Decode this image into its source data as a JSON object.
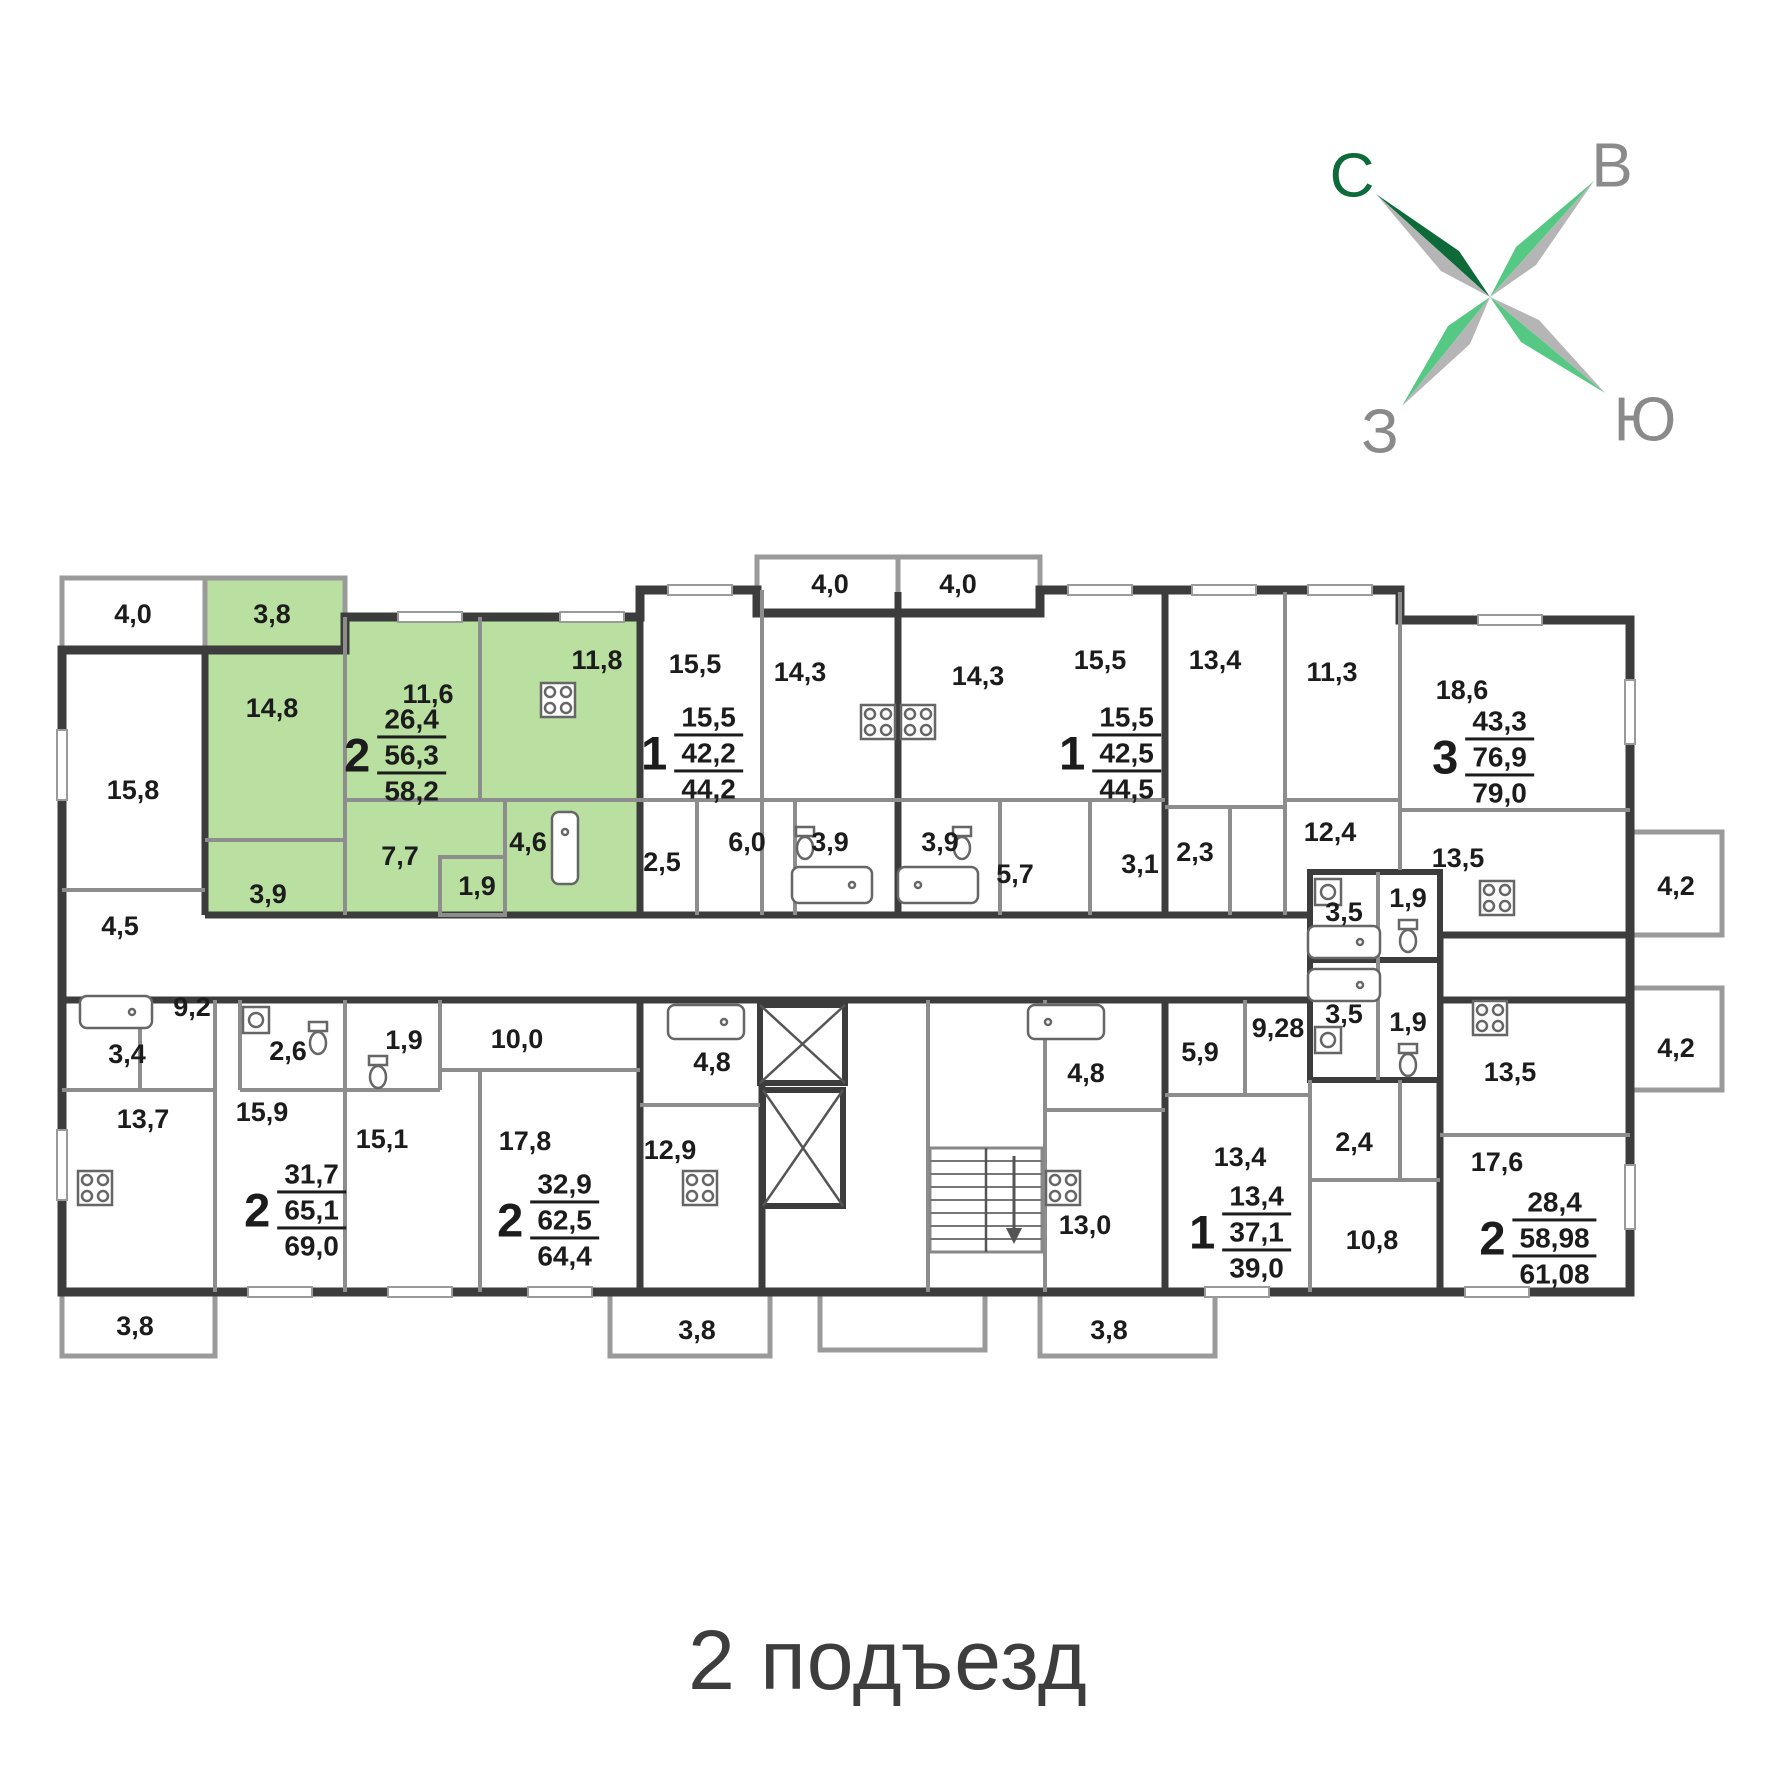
{
  "title": "2 подъезд",
  "compass": {
    "north": "С",
    "east": "В",
    "west": "З",
    "south": "Ю"
  },
  "colors": {
    "highlight_green": "#b9e0a1",
    "wall_dark": "#3c3c3c",
    "wall_gray": "#8d8d8d",
    "compass_dark_green": "#0e6b39",
    "compass_green": "#55c983",
    "compass_gray": "#b5b5b5",
    "direction_label_gray": "#8a8a8a"
  },
  "apartments": [
    {
      "name": "2-room highlighted",
      "rooms": "2",
      "area_living": "26,4",
      "area_main": "56,3",
      "area_total": "58,2",
      "highlighted": true
    },
    {
      "name": "1-room left",
      "rooms": "1",
      "area_living": "15,5",
      "area_main": "42,2",
      "area_total": "44,2",
      "highlighted": false
    },
    {
      "name": "1-room right",
      "rooms": "1",
      "area_living": "15,5",
      "area_main": "42,5",
      "area_total": "44,5",
      "highlighted": false
    },
    {
      "name": "3-room",
      "rooms": "3",
      "area_living": "43,3",
      "area_main": "76,9",
      "area_total": "79,0",
      "highlighted": false
    },
    {
      "name": "2-room bottom-left",
      "rooms": "2",
      "area_living": "31,7",
      "area_main": "65,1",
      "area_total": "69,0",
      "highlighted": false
    },
    {
      "name": "2-room bottom-mid",
      "rooms": "2",
      "area_living": "32,9",
      "area_main": "62,5",
      "area_total": "64,4",
      "highlighted": false
    },
    {
      "name": "1-room bottom",
      "rooms": "1",
      "area_living": "13,4",
      "area_main": "37,1",
      "area_total": "39,0",
      "highlighted": false
    },
    {
      "name": "2-room bottom-right",
      "rooms": "2",
      "area_living": "28,4",
      "area_main": "58,98",
      "area_total": "61,08",
      "highlighted": false
    }
  ],
  "room_labels": {
    "bal_40_tl": "4,0",
    "bal_38_tl": "3,8",
    "r_158": "15,8",
    "r_148": "14,8",
    "r_116": "11,6",
    "r_118": "11,8",
    "r_77": "7,7",
    "r_39_g": "3,9",
    "r_19_g": "1,9",
    "r_46": "4,6",
    "m_bal40a": "4,0",
    "m_bal40b": "4,0",
    "r_155_a": "15,5",
    "r_143_a": "14,3",
    "r_143_b": "14,3",
    "r_155_b": "15,5",
    "r_25": "2,5",
    "r_60": "6,0",
    "r_39_a": "3,9",
    "r_39_b": "3,9",
    "r_57": "5,7",
    "r_31": "3,1",
    "r_134_a": "13,4",
    "r_113": "11,3",
    "r_186": "18,6",
    "r_124": "12,4",
    "r_135_a": "13,5",
    "r_23": "2,3",
    "r_35_a": "3,5",
    "r_19_a": "1,9",
    "bal_42_a": "4,2",
    "bal_42_b": "4,2",
    "r_35_b": "3,5",
    "r_19_b": "1,9",
    "r_928": "9,28",
    "r_59": "5,9",
    "r_135_b": "13,5",
    "r_24": "2,4",
    "r_134_b": "13,4",
    "r_108": "10,8",
    "r_176": "17,6",
    "bal_38_r": "3,8",
    "r_45": "4,5",
    "r_92": "9,2",
    "r_34": "3,4",
    "r_137": "13,7",
    "r_26": "2,6",
    "r_19_c": "1,9",
    "r_100": "10,0",
    "r_159": "15,9",
    "r_151": "15,1",
    "r_178": "17,8",
    "bal_38_l": "3,8",
    "bal_38_c": "3,8",
    "r_48_a": "4,8",
    "r_129": "12,9",
    "r_48_b": "4,8",
    "r_130": "13,0"
  }
}
